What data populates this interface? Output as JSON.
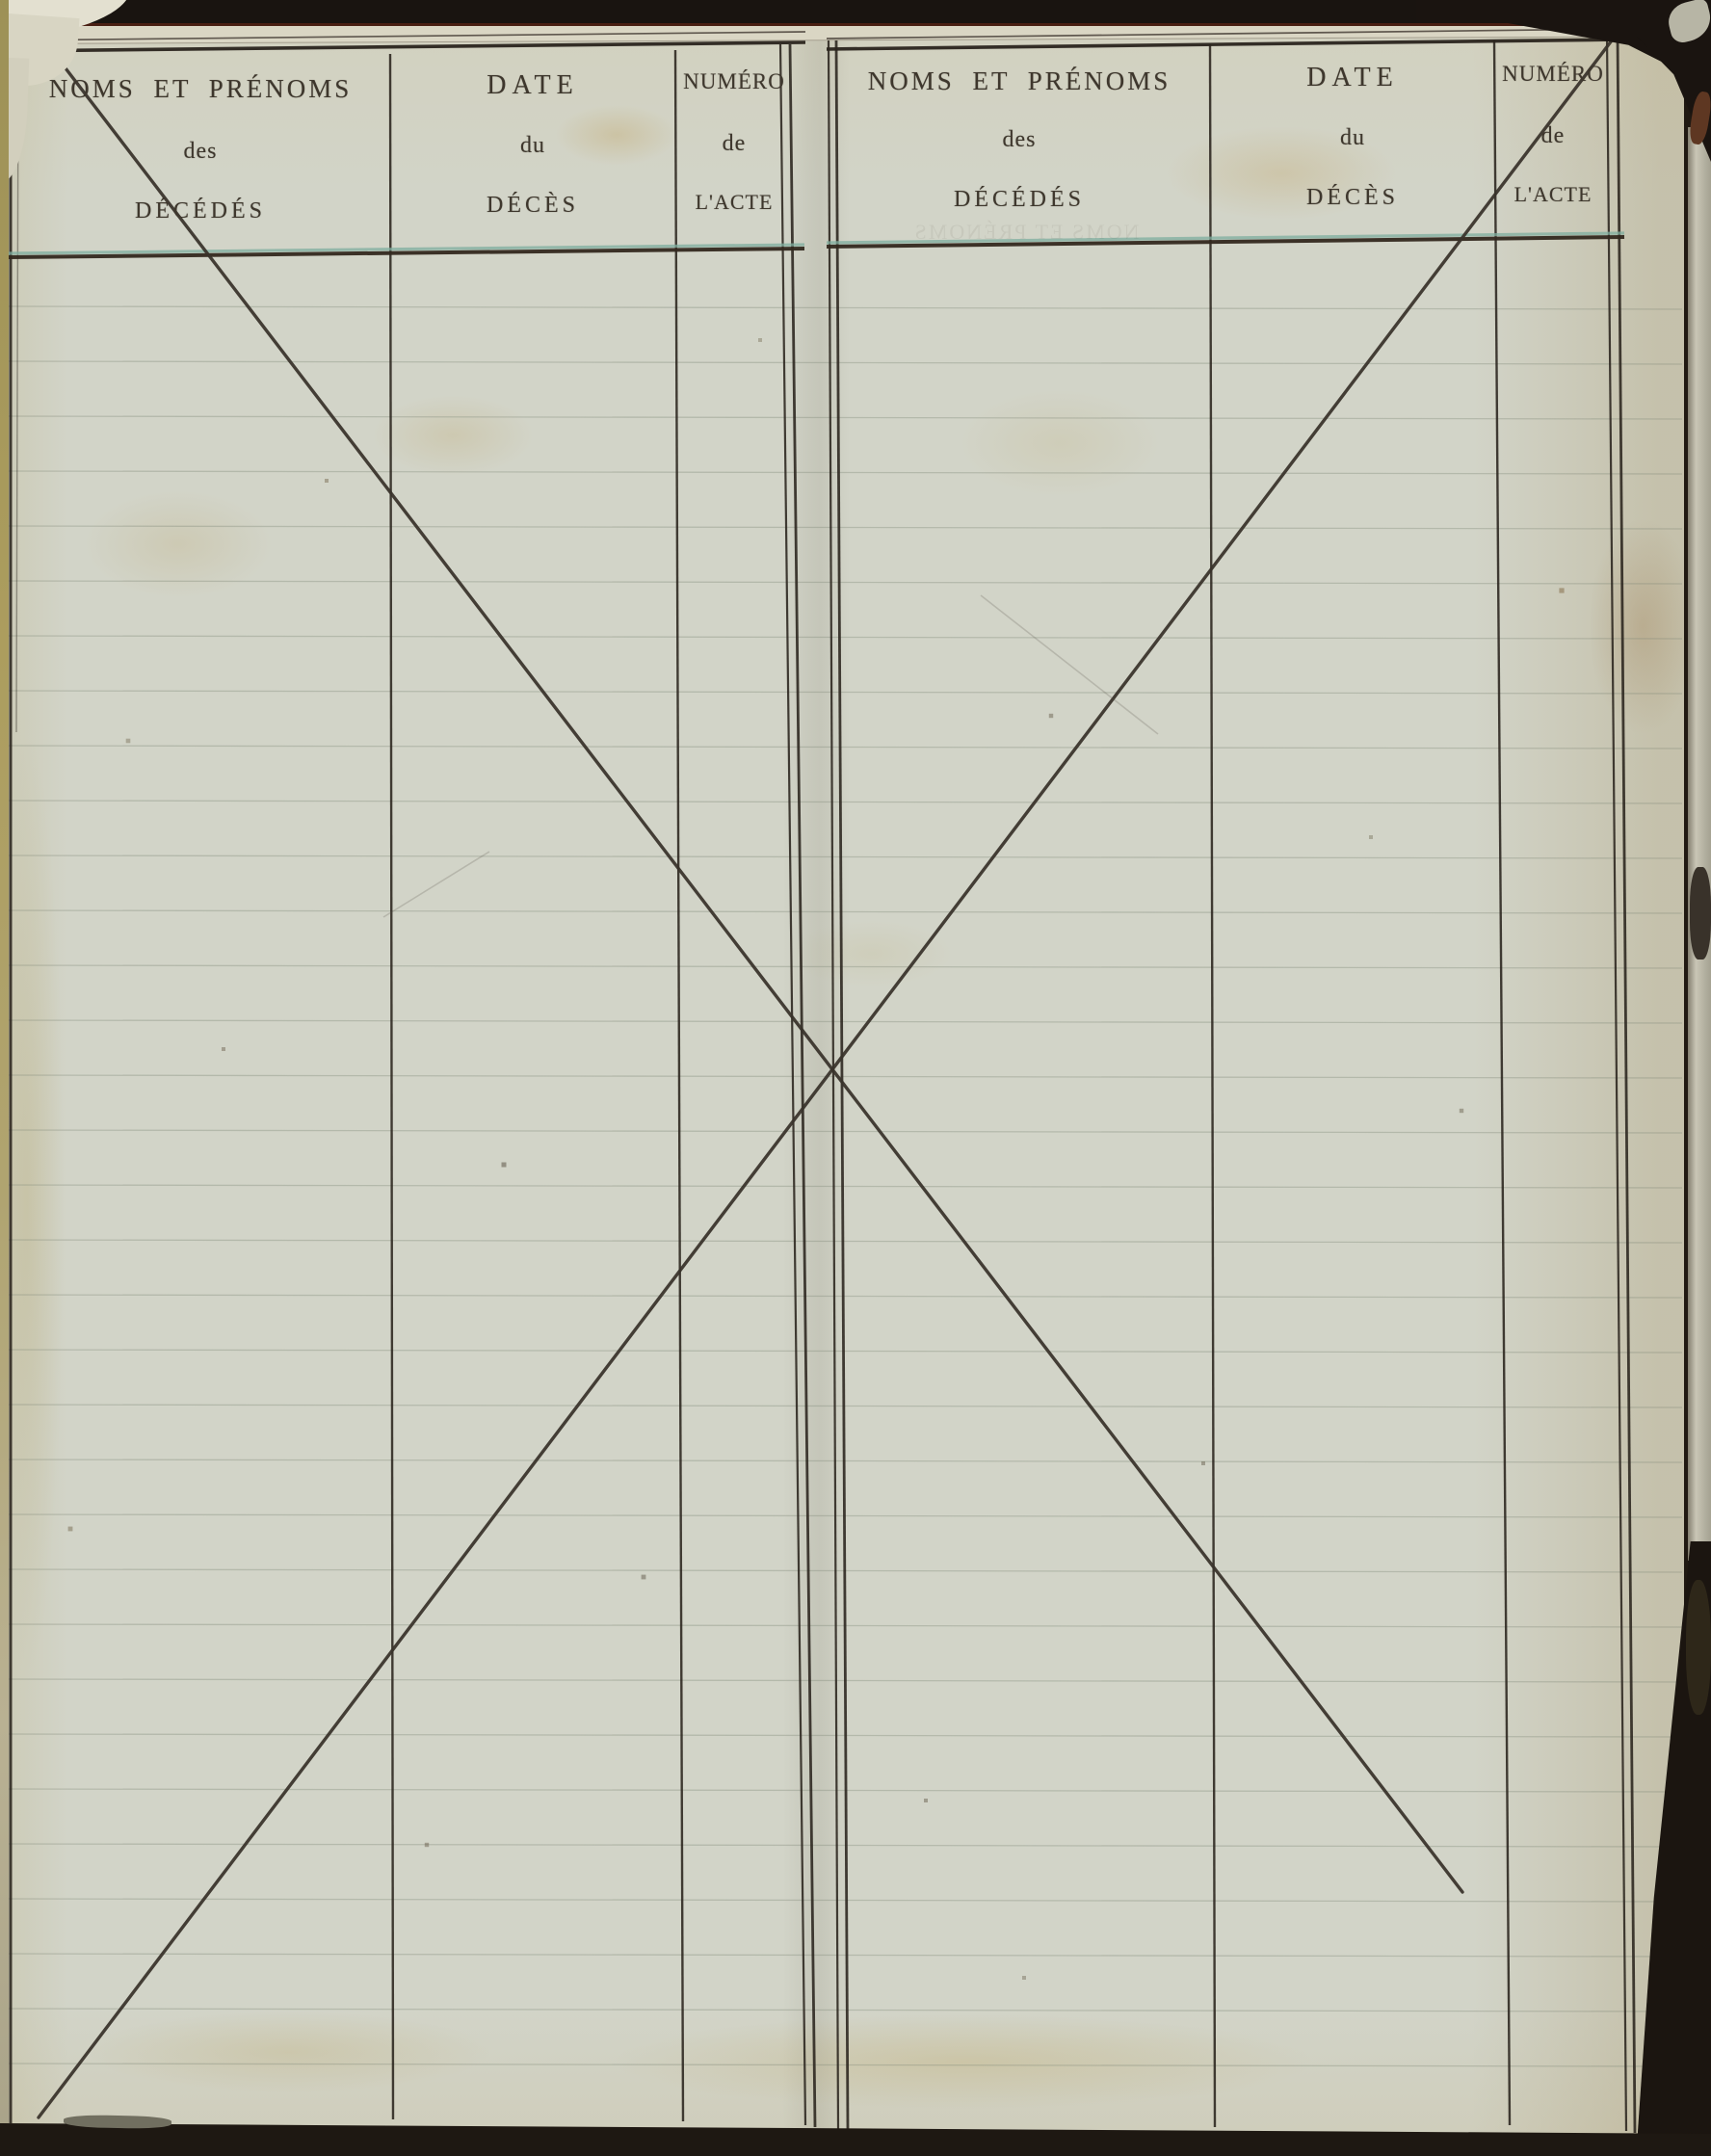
{
  "tables": [
    {
      "side": "left",
      "columns": [
        {
          "l1": "NOMS ET PRÉNOMS",
          "l2": "des",
          "l3": "DÉCÉDÉS"
        },
        {
          "l1": "DATE",
          "l2": "du",
          "l3": "DÉCÈS"
        },
        {
          "l1": "NUMÉRO",
          "l2": "de",
          "l3": "L'ACTE"
        }
      ]
    },
    {
      "side": "right",
      "columns": [
        {
          "l1": "NOMS ET PRÉNOMS",
          "l2": "des",
          "l3": "DÉCÉDÉS"
        },
        {
          "l1": "DATE",
          "l2": "du",
          "l3": "DÉCÈS"
        },
        {
          "l1": "NUMÉRO",
          "l2": "de",
          "l3": "L'ACTE"
        }
      ]
    }
  ],
  "marks": {
    "diagonal_stroke_1": "ink-cancellation-stroke-topleft-to-bottomright",
    "diagonal_stroke_2": "ink-cancellation-stroke-bottomleft-to-topright",
    "margin_tick": "small-ink-tick-top-right-margin"
  },
  "colors": {
    "paper": "#d2d4c8",
    "ink": "#3e372d",
    "line": "#2b251e",
    "teal": "#7fae9f",
    "edge": "#1c1610",
    "cream": "#dad6c4",
    "binding_light": "#c7c4b4"
  }
}
